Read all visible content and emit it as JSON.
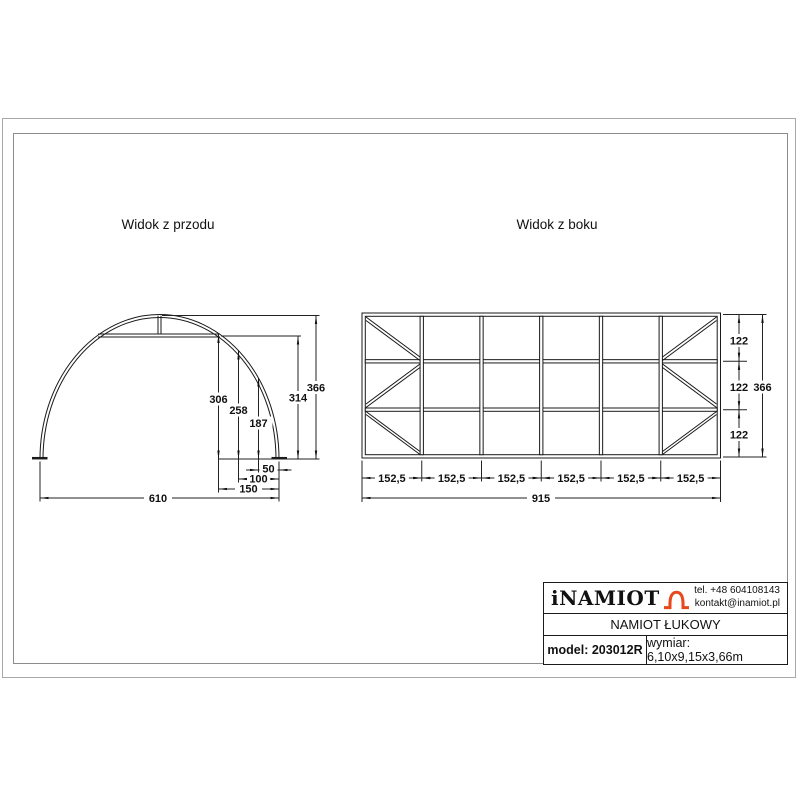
{
  "front_view": {
    "title": "Widok z przodu",
    "dims": {
      "total_height": "366",
      "chord_height": "314",
      "h_at_150": "306",
      "h_at_100": "258",
      "h_at_50": "187",
      "offset_50": "50",
      "offset_100": "100",
      "offset_150": "150",
      "base_width": "610"
    }
  },
  "side_view": {
    "title": "Widok z boku",
    "dims": {
      "bay_width": "152,5",
      "total_length": "915",
      "row_height": "122",
      "total_height": "366"
    }
  },
  "title_block": {
    "brand": "iNAMIOT",
    "phone": "tel. +48 604108143",
    "email": "kontakt@inamiot.pl",
    "product_name": "NAMIOT ŁUKOWY",
    "model": "model: 203012R",
    "dimensions": "wymiar: 6,10x9,15x3,66m",
    "accent_color": "#e8491c"
  }
}
